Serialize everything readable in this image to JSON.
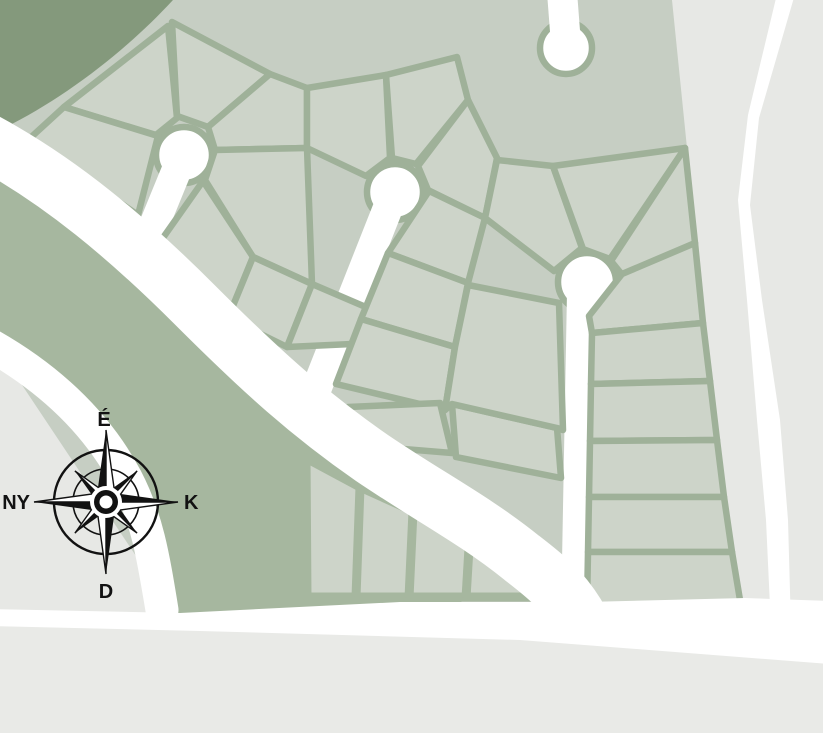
{
  "compass": {
    "north_label": "É",
    "east_label": "K",
    "south_label": "D",
    "west_label": "NY"
  },
  "colors": {
    "background": "#e7e8e5",
    "background_bottom": "#e9eae7",
    "road_white": "#ffffff",
    "forest_green": "#84997c",
    "verge_green": "#a6b79f",
    "parcel_area": "#c6cec3",
    "lot_fill": "#cdd4c9",
    "lot_line": "#9fb199",
    "compass_ink": "#121212"
  }
}
